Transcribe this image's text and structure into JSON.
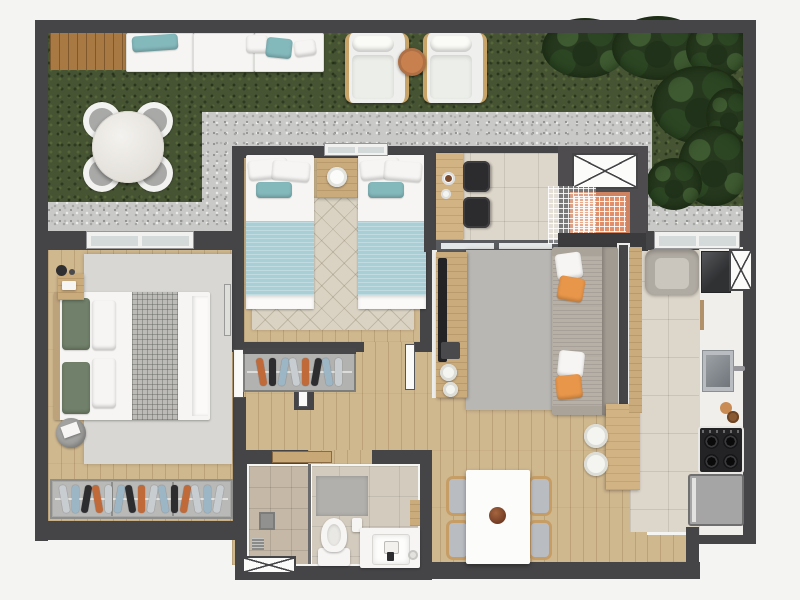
{
  "scene": {
    "kind": "rendered-apartment-floor-plan-top-view",
    "rooms": [
      {
        "name": "garden-terrace",
        "objects": [
          "wood-deck",
          "outdoor-bench",
          "bench-cushions",
          "round-marble-table",
          "garden-chairs",
          "lounge-chairs",
          "round-side-table",
          "gravel-path",
          "grass-lawn",
          "shrubs"
        ]
      },
      {
        "name": "master-bedroom",
        "objects": [
          "double-bed",
          "sage-pillows",
          "plaid-runner",
          "nightstand",
          "table-lamp",
          "area-rug",
          "pouf",
          "wardrobe-with-clothes",
          "window"
        ]
      },
      {
        "name": "twin-bedroom",
        "objects": [
          "single-bed-left",
          "single-bed-right",
          "teal-blankets",
          "nightstand",
          "round-lamp",
          "diamond-rug",
          "window"
        ]
      },
      {
        "name": "hallway",
        "objects": [
          "open-wardrobe-with-clothes",
          "doors"
        ]
      },
      {
        "name": "balcony-nook",
        "objects": [
          "bar-counter",
          "coffee-cups",
          "black-chairs",
          "sliding-door"
        ]
      },
      {
        "name": "service-niche",
        "objects": [
          "shaft-box",
          "barbecue-grill",
          "wire-grid"
        ]
      },
      {
        "name": "living-room",
        "objects": [
          "sofa",
          "orange-pillows",
          "white-pillows",
          "tv-sideboard",
          "tv",
          "round-poufs",
          "area-rug",
          "armchair",
          "partition-wall"
        ]
      },
      {
        "name": "dining-area",
        "objects": [
          "dining-table",
          "bowl",
          "dining-chairs",
          "breakfast-bar",
          "bar-stools"
        ]
      },
      {
        "name": "kitchen",
        "objects": [
          "counter",
          "dark-sink",
          "steel-sink",
          "faucet",
          "cooktop",
          "fridge",
          "shaft-box",
          "window",
          "tall-cabinet"
        ]
      },
      {
        "name": "bathroom",
        "objects": [
          "shower",
          "glass-screen",
          "drain",
          "bath-mat",
          "toilet",
          "vanity-sink",
          "wall-shelf",
          "shaft-box",
          "door"
        ]
      }
    ]
  },
  "palette": {
    "wall": "#454547",
    "wallDark": "#3b3b3d",
    "bgOutside": "#f4f4f3",
    "gravel": "#c9c9c7",
    "grass": "#475434",
    "plantDark": "#26391e",
    "plantLight": "#3e5a31",
    "deck": "#a87943",
    "woodFloor": "#cfb78e",
    "woodFurniture": "#c9ab7c",
    "barWood": "#d2b384",
    "tile": "#ddd6ca",
    "bathTile": "#d3cbbe",
    "showerTile": "#c5b8a7",
    "rugMaster": "#d8d7d3",
    "rugTwin": "#dad3c3",
    "rugLiving": "#b9b7b3",
    "white": "#f6f5f3",
    "marble": "#edebe7",
    "teal": "#a9ced6",
    "tealDark": "#84b9bc",
    "sage": "#71806a",
    "plaid": "#bcbbb7",
    "sofa": "#b3aca3",
    "sofaBack": "#a29b92",
    "orange": "#e8964a",
    "grillOrange": "#e28f69",
    "seat": "#b9bdc2",
    "chairWood": "#c79d66",
    "black": "#29292b",
    "metal": "#a6abaf",
    "fridge": "#a5a5a5",
    "stoveBlack": "#232325",
    "matGray": "#b2b0ac",
    "pouf": "#a2a2a0",
    "sideTableTan": "#c8804f",
    "glass": "#d4dada",
    "doorWood": "#c9a877"
  },
  "wardrobes": {
    "master": {
      "clothes": [
        "#c8cdd1",
        "#9cb6c6",
        "#2d2d30",
        "#c06a3a",
        "#c8cdd1",
        "#9cb6c6",
        "#2d2d30",
        "#c06a3a",
        "#c8cdd1",
        "#9cb6c6",
        "#2d2d30",
        "#c06a3a",
        "#c8cdd1",
        "#9cb6c6",
        "#c8cdd1"
      ]
    },
    "hall": {
      "clothes": [
        "#c06a3a",
        "#2d2d30",
        "#9cb6c6",
        "#c8cdd1",
        "#c06a3a",
        "#2d2d30",
        "#9cb6c6",
        "#c8cdd1"
      ]
    }
  }
}
